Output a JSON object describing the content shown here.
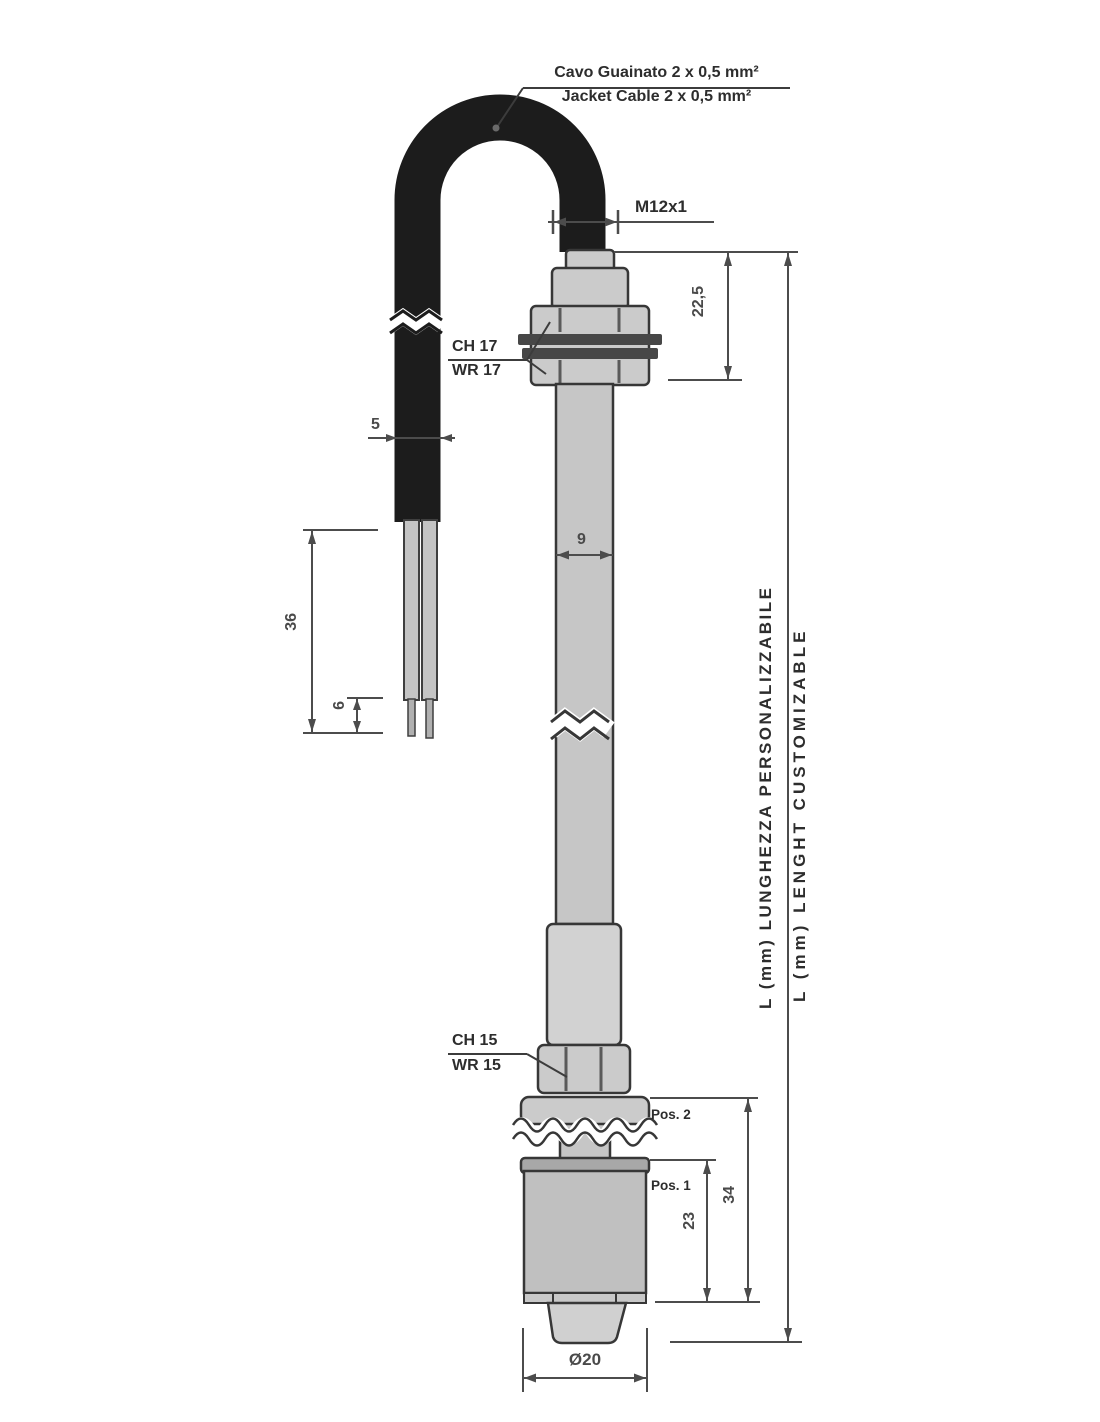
{
  "title": "Float level sensor technical drawing",
  "labels": {
    "cable_spec_it": "Cavo Guainato 2 x 0,5 mm²",
    "cable_spec_en": "Jacket Cable 2 x 0,5 mm²",
    "thread": "M12x1",
    "wrench_top_it": "CH 17",
    "wrench_top_en": "WR 17",
    "wrench_bottom_it": "CH 15",
    "wrench_bottom_en": "WR 15",
    "length_it": "L (mm) LUNGHEZZA PERSONALIZZABILE",
    "length_en": "L (mm) LENGHT CUSTOMIZABLE",
    "pos2": "Pos. 2",
    "pos1": "Pos. 1"
  },
  "dimensions": {
    "thread_length": "22,5",
    "cable_diameter": "5",
    "tube_diameter": "9",
    "wire_length": "36",
    "wire_strip_length": "6",
    "float_pos1_height": "23",
    "float_total_height": "34",
    "float_diameter": "Ø20"
  },
  "colors": {
    "cable": "#1c1c1c",
    "metal_light": "#cbcbcb",
    "metal_mid": "#c0c0c0",
    "washer_dark": "#474747",
    "line": "#4c4c4c"
  }
}
